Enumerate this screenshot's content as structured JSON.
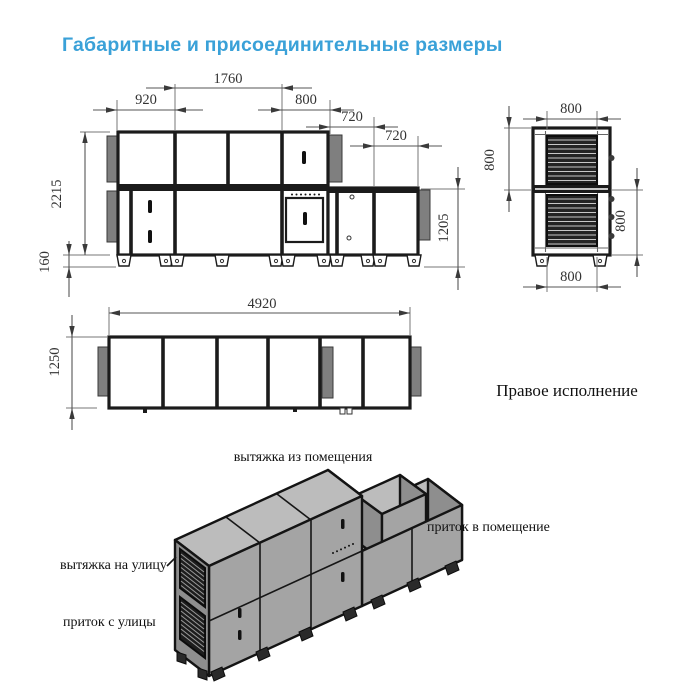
{
  "title": "Габаритные и присоединительные размеры",
  "front_view": {
    "dim_1760": "1760",
    "dim_920": "920",
    "dim_800": "800",
    "dim_720_upper": "720",
    "dim_720_lower": "720",
    "dim_height": "2215",
    "dim_base_height": "160",
    "dim_right_height": "1205"
  },
  "side_view": {
    "dim_width_top": "800",
    "dim_upper_height": "800",
    "dim_lower_height": "800",
    "dim_width_bottom": "800"
  },
  "plan_view": {
    "dim_length": "4920",
    "dim_width": "1250"
  },
  "variant_label": "Правое исполнение",
  "isometric": {
    "label_exhaust_from_room": "вытяжка из помещения",
    "label_supply_to_room": "приток в помещение",
    "label_exhaust_to_outside": "вытяжка на улицу",
    "label_supply_from_outside": "приток с улицы"
  },
  "colors": {
    "accent": "#3aa1d8",
    "line": "#1b1b1b",
    "flange_gray": "#7f7f7f",
    "iso_top": "#bcbcbc",
    "iso_front": "#a4a4a4",
    "iso_side": "#8e8e8e"
  }
}
